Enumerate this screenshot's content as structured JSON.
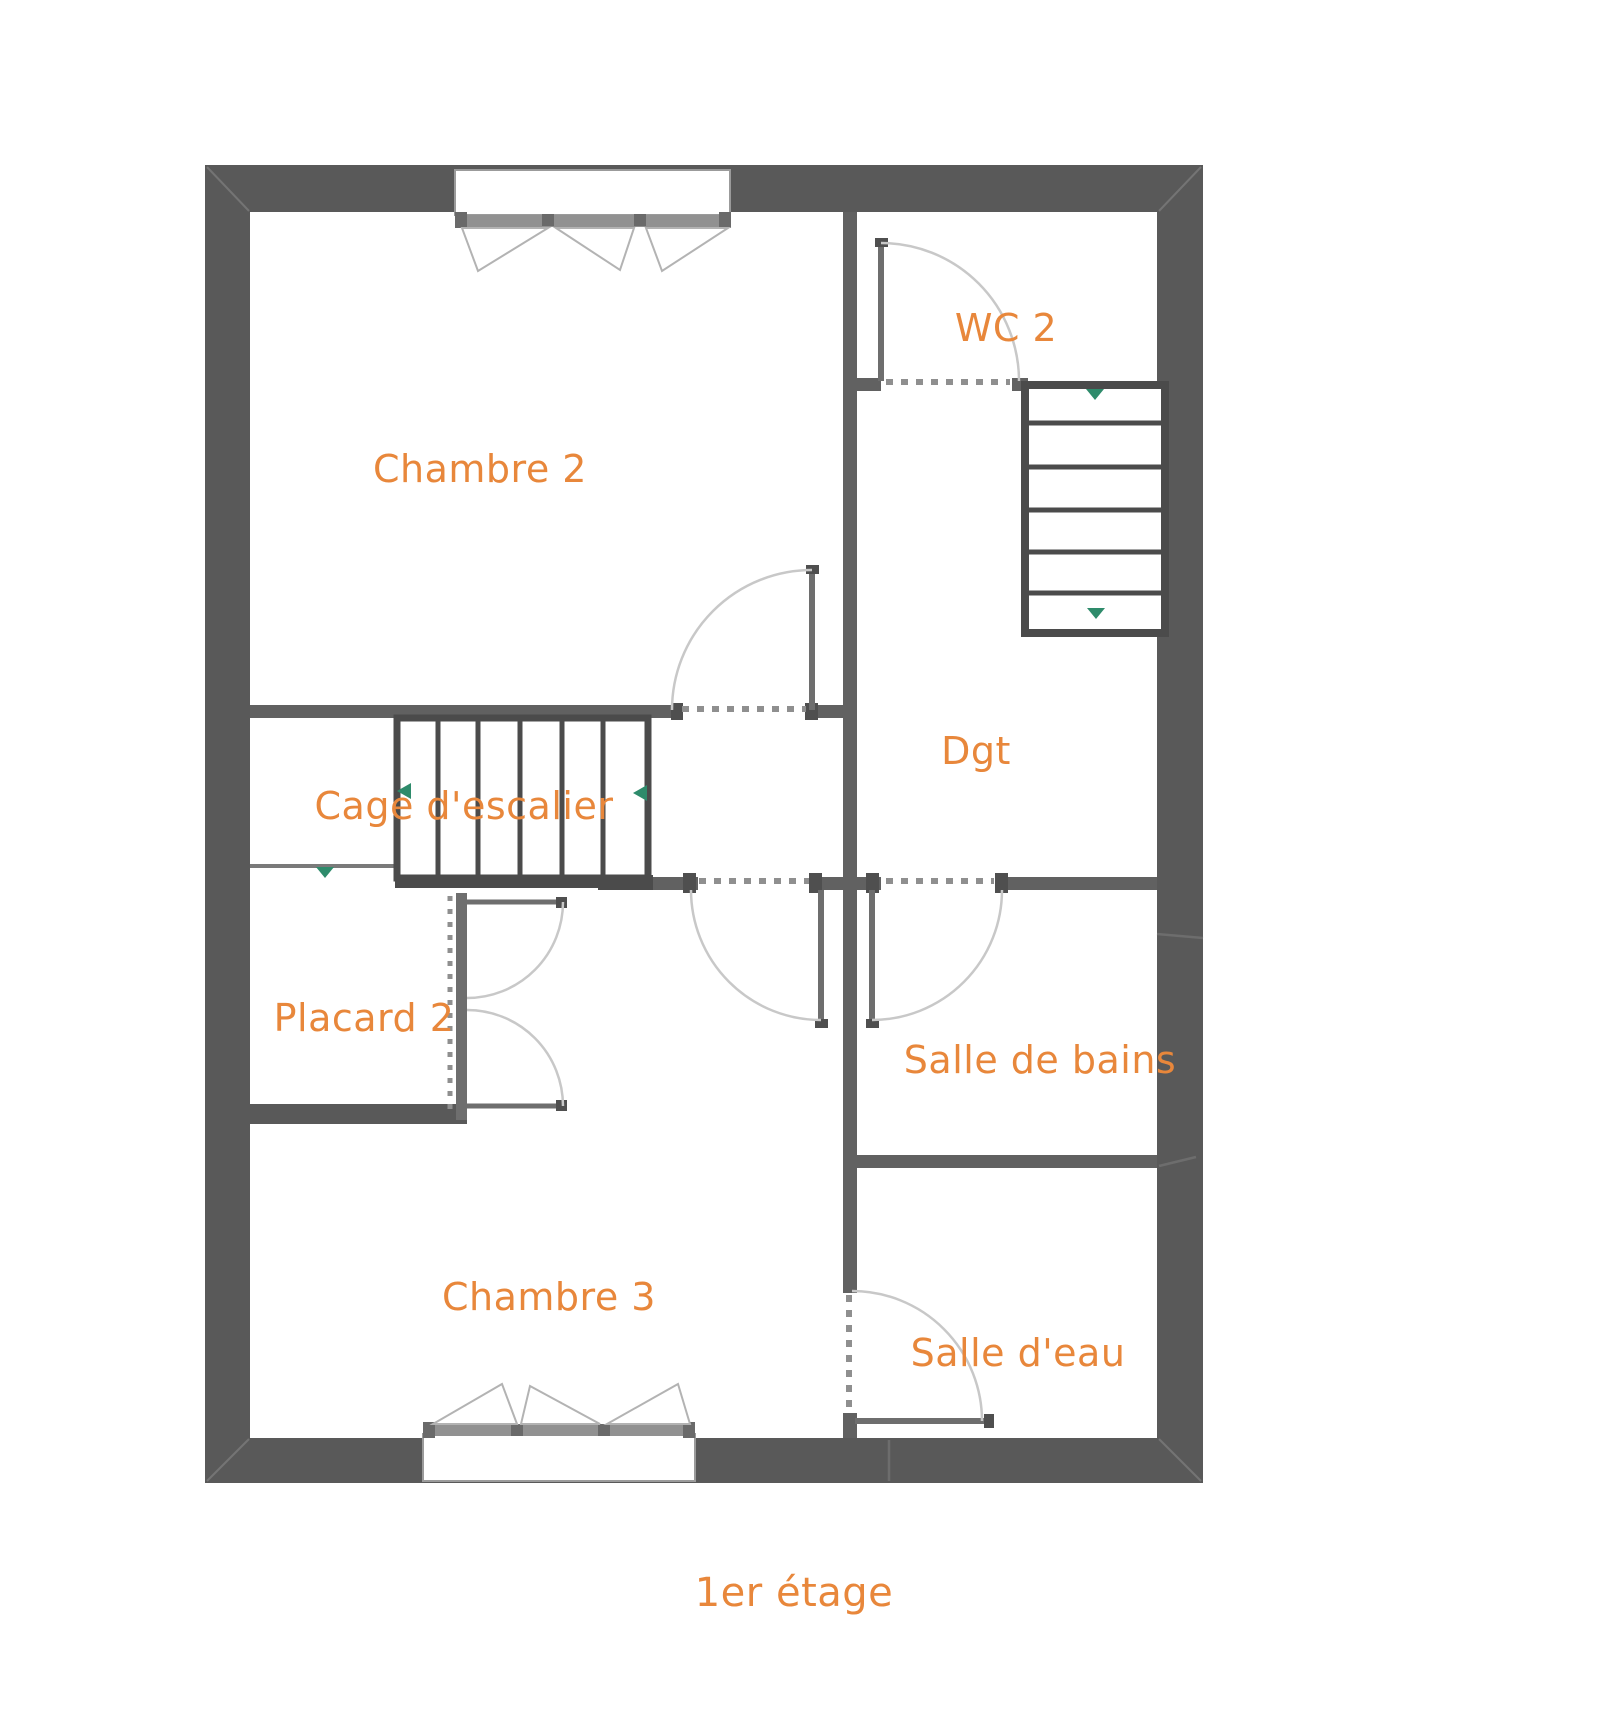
{
  "plan": {
    "caption": "1er étage",
    "rooms": [
      {
        "id": "chambre-2",
        "label": "Chambre 2"
      },
      {
        "id": "wc-2",
        "label": "WC 2"
      },
      {
        "id": "dgt",
        "label": "Dgt"
      },
      {
        "id": "cage-escalier",
        "label": "Cage d'escalier"
      },
      {
        "id": "placard-2",
        "label": "Placard 2"
      },
      {
        "id": "salle-de-bains",
        "label": "Salle de bains"
      },
      {
        "id": "chambre-3",
        "label": "Chambre 3"
      },
      {
        "id": "salle-d-eau",
        "label": "Salle d'eau"
      }
    ],
    "stairs": {
      "upper_staircase": {
        "location": "right, below WC 2",
        "treads": 6,
        "direction_arrows": 2
      },
      "cage_staircase": {
        "location": "center-left",
        "treads": 6,
        "direction_arrows": 3
      }
    },
    "windows": [
      {
        "id": "window-top",
        "wall": "north",
        "room": "Chambre 2",
        "casement_triangles": 3
      },
      {
        "id": "window-bottom",
        "wall": "south",
        "room": "Chambre 3",
        "casement_triangles": 3
      }
    ],
    "doors": [
      {
        "id": "door-wc2",
        "room": "WC 2"
      },
      {
        "id": "door-chambre2",
        "room": "Chambre 2"
      },
      {
        "id": "door-chambre3",
        "room": "Chambre 3"
      },
      {
        "id": "door-salle-de-bains",
        "room": "Salle de bains"
      },
      {
        "id": "door-salle-d-eau",
        "room": "Salle d'eau"
      },
      {
        "id": "placard-double-doors",
        "room": "Placard 2"
      }
    ],
    "colors": {
      "background": "#FFFFFF",
      "exterior_wall": "#595959",
      "interior_wall": "#616161",
      "stair_outline": "#4B4B4B",
      "label_orange": "#E8873B",
      "arrow_green": "#2E8B6B",
      "door_arc": "#C8C8C8",
      "threshold_dash": "#8F8F8F"
    }
  }
}
